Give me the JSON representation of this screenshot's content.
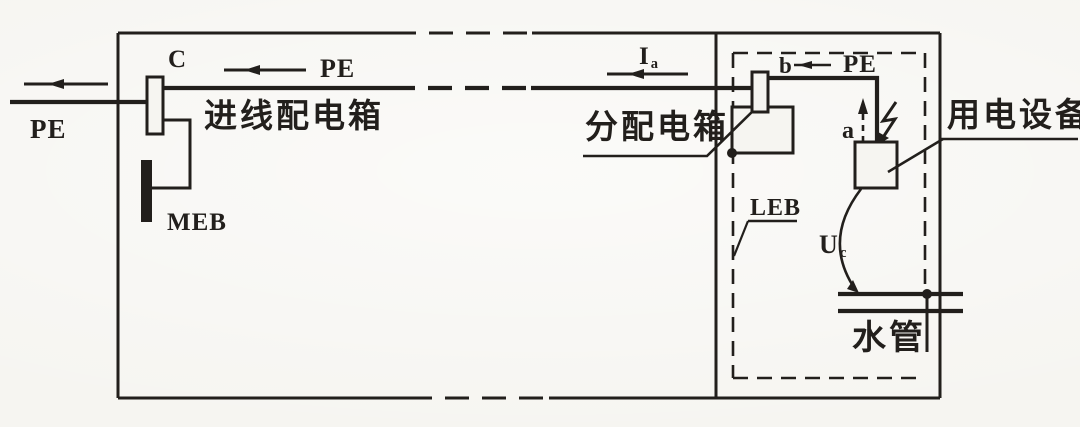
{
  "colors": {
    "paper": "#f6f5f1",
    "ink": "#221f1c"
  },
  "labels": {
    "pe_incoming": "PE",
    "c_terminal": "C",
    "pe_trunk": "PE",
    "incoming_box": "进线配电箱",
    "meb": "MEB",
    "ia_symbol": "I",
    "ia_sub": "a",
    "dist_box": "分配电箱",
    "b_terminal": "b",
    "pe_branch": "PE",
    "a_point": "a",
    "equipment": "用电设备",
    "leb": "LEB",
    "uc_symbol": "U",
    "uc_sub": "c",
    "water_pipe": "水管"
  }
}
